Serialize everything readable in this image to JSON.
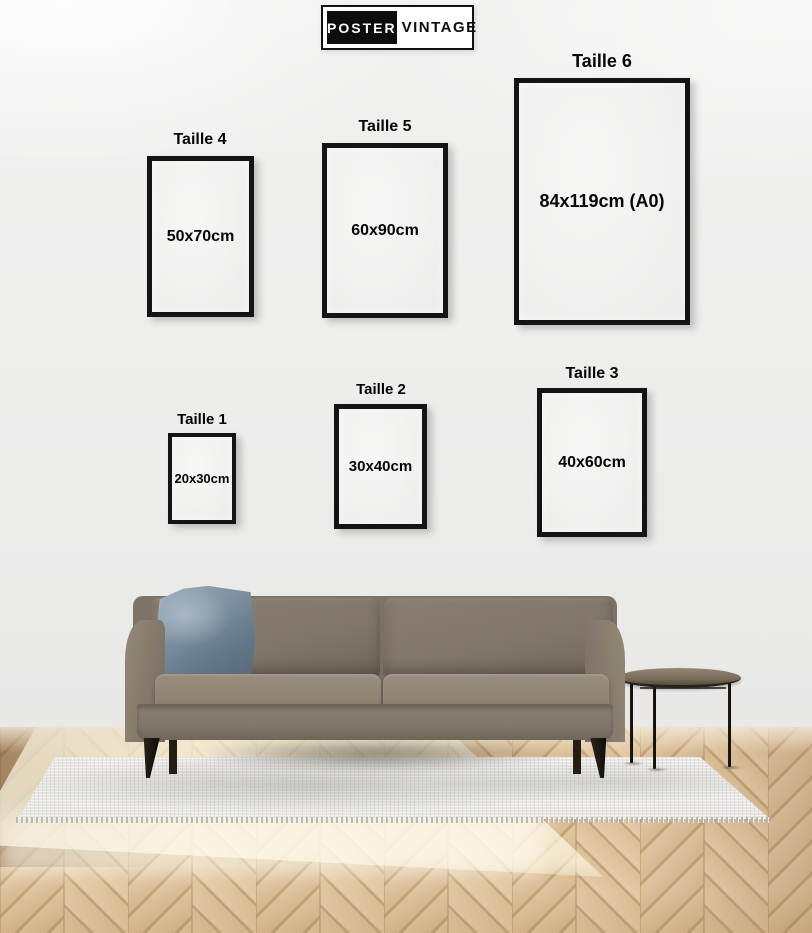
{
  "brand": {
    "primary": "POSTER",
    "secondary": "VINTAGE"
  },
  "size_guide": {
    "frames": [
      {
        "id": 1,
        "label": "Taille 1",
        "size": "20x30cm"
      },
      {
        "id": 2,
        "label": "Taille 2",
        "size": "30x40cm"
      },
      {
        "id": 3,
        "label": "Taille 3",
        "size": "40x60cm"
      },
      {
        "id": 4,
        "label": "Taille 4",
        "size": "50x70cm"
      },
      {
        "id": 5,
        "label": "Taille 5",
        "size": "60x90cm"
      },
      {
        "id": 6,
        "label": "Taille 6",
        "size": "84x119cm (A0)"
      }
    ]
  },
  "scene": {
    "items": [
      "wall",
      "herringbone-wood-floor",
      "gray-rug",
      "taupe-sofa",
      "blue-pillow",
      "round-side-table"
    ]
  },
  "palette": {
    "frame_border": "#141414",
    "text": "#050505",
    "wall": "#ededec",
    "logo_black": "#0d0d0d",
    "logo_white": "#ffffff",
    "wood_mid": "#d9bc95",
    "wood_seam": "#bd9c72",
    "rug": "#e8e7e3",
    "sofa_body": "#867b6d",
    "sofa_seat": "#958a7b",
    "pillow_blue": "#7b8ea0",
    "leg_black": "#17130f",
    "table_top": "#857767"
  }
}
